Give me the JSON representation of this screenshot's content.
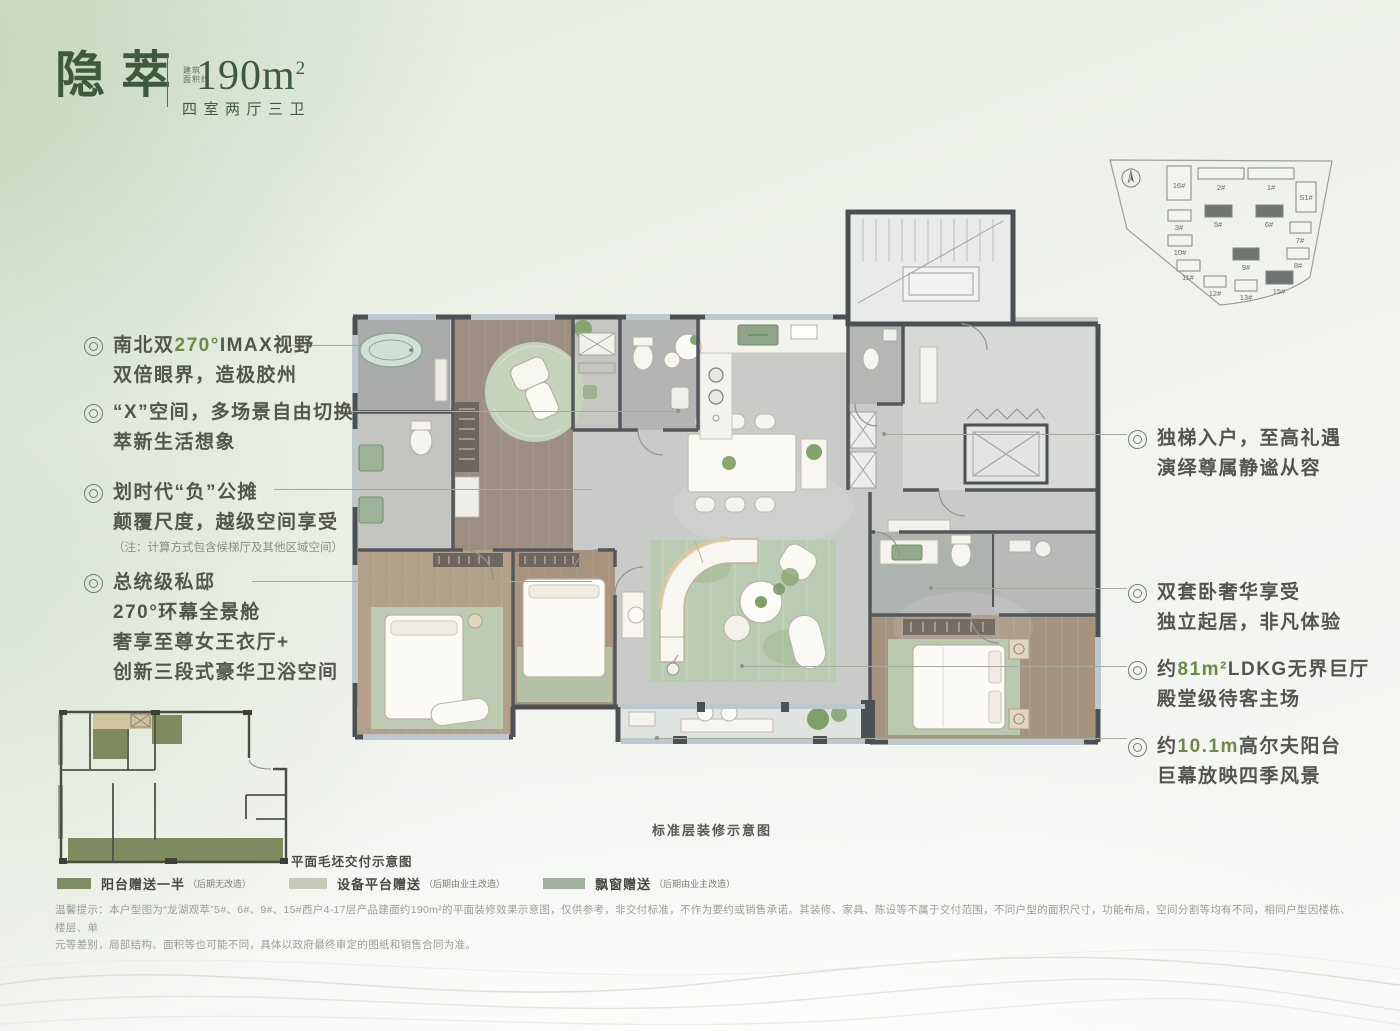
{
  "header": {
    "title": "隐萃",
    "area_prefix": [
      "建筑",
      "面积约"
    ],
    "area_value": "190m",
    "area_sup": "2",
    "layout_type": "四室两厅三卫"
  },
  "site_plan": {
    "buildings": [
      {
        "label": "16#",
        "highlighted": false
      },
      {
        "label": "2#",
        "highlighted": false
      },
      {
        "label": "1#",
        "highlighted": false
      },
      {
        "label": "S1#",
        "highlighted": false
      },
      {
        "label": "3#",
        "highlighted": false
      },
      {
        "label": "5#",
        "highlighted": true
      },
      {
        "label": "6#",
        "highlighted": true
      },
      {
        "label": "7#",
        "highlighted": false
      },
      {
        "label": "10#",
        "highlighted": false
      },
      {
        "label": "9#",
        "highlighted": true
      },
      {
        "label": "8#",
        "highlighted": false
      },
      {
        "label": "11#",
        "highlighted": false
      },
      {
        "label": "12#",
        "highlighted": false
      },
      {
        "label": "13#",
        "highlighted": false
      },
      {
        "label": "15#",
        "highlighted": true
      }
    ]
  },
  "annotations": {
    "left": [
      {
        "pre": "南北双",
        "highlight": "270°",
        "post": "IMAX视野",
        "line2": "双倍眼界，造极胶州"
      },
      {
        "line1": "“X”空间，多场景自由切换",
        "line2": "萃新生活想象"
      },
      {
        "line1": "划时代“负”公摊",
        "line2": "颠覆尺度，越级空间享受",
        "note": "（注：计算方式包含候梯厅及其他区域空间）"
      },
      {
        "line1": "总统级私邸",
        "line2": "270°环幕全景舱",
        "line3": "奢享至尊女王衣厅+",
        "line4": "创新三段式豪华卫浴空间"
      }
    ],
    "right": [
      {
        "line1": "独梯入户，至高礼遇",
        "line2": "演绎尊属静谧从容"
      },
      {
        "line1": "双套卧奢华享受",
        "line2": "独立起居，非凡体验"
      },
      {
        "pre": "约",
        "highlight": "81m²",
        "post": "LDKG无界巨厅",
        "line2": "殿堂级待客主场"
      },
      {
        "pre": "约",
        "highlight": "10.1m",
        "post": "高尔夫阳台",
        "line2": "巨幕放映四季风景"
      }
    ]
  },
  "captions": {
    "decorated_plan": "标准层装修示意图",
    "bare_plan": "平面毛坯交付示意图"
  },
  "legend": {
    "items": [
      {
        "label": "阳台赠送一半",
        "note": "（后期无改造）",
        "color": "#7e8c61"
      },
      {
        "label": "设备平台赠送",
        "note": "（后期由业主改造）",
        "color": "#c8c8b6"
      },
      {
        "label": "飘窗赠送",
        "note": "（后期由业主改造）",
        "color": "#a2b19e"
      }
    ]
  },
  "disclaimer": {
    "line1": "温馨提示：本户型图为“龙湖观萃”5#、6#、9#、15#西户4-17层产品建面约190m²的平面装修效果示意图，仅供参考，非交付标准，不作为要约或销售承诺。其装修、家具、陈设等不属于交付范围，不同户型的面积尺寸，功能布局，空间分割等均有不同，相同户型因楼栋、楼层、单",
    "line2": "元等差别，局部结构、面积等也可能不同，具体以政府最终审定的图纸和销售合同为准。"
  },
  "colors": {
    "title_green": "#3e5a3c",
    "accent_green": "#6d8a4a",
    "wall": "#4b5054",
    "rug_green": "#b9cbb0",
    "wood_floor": "#a6937f"
  }
}
